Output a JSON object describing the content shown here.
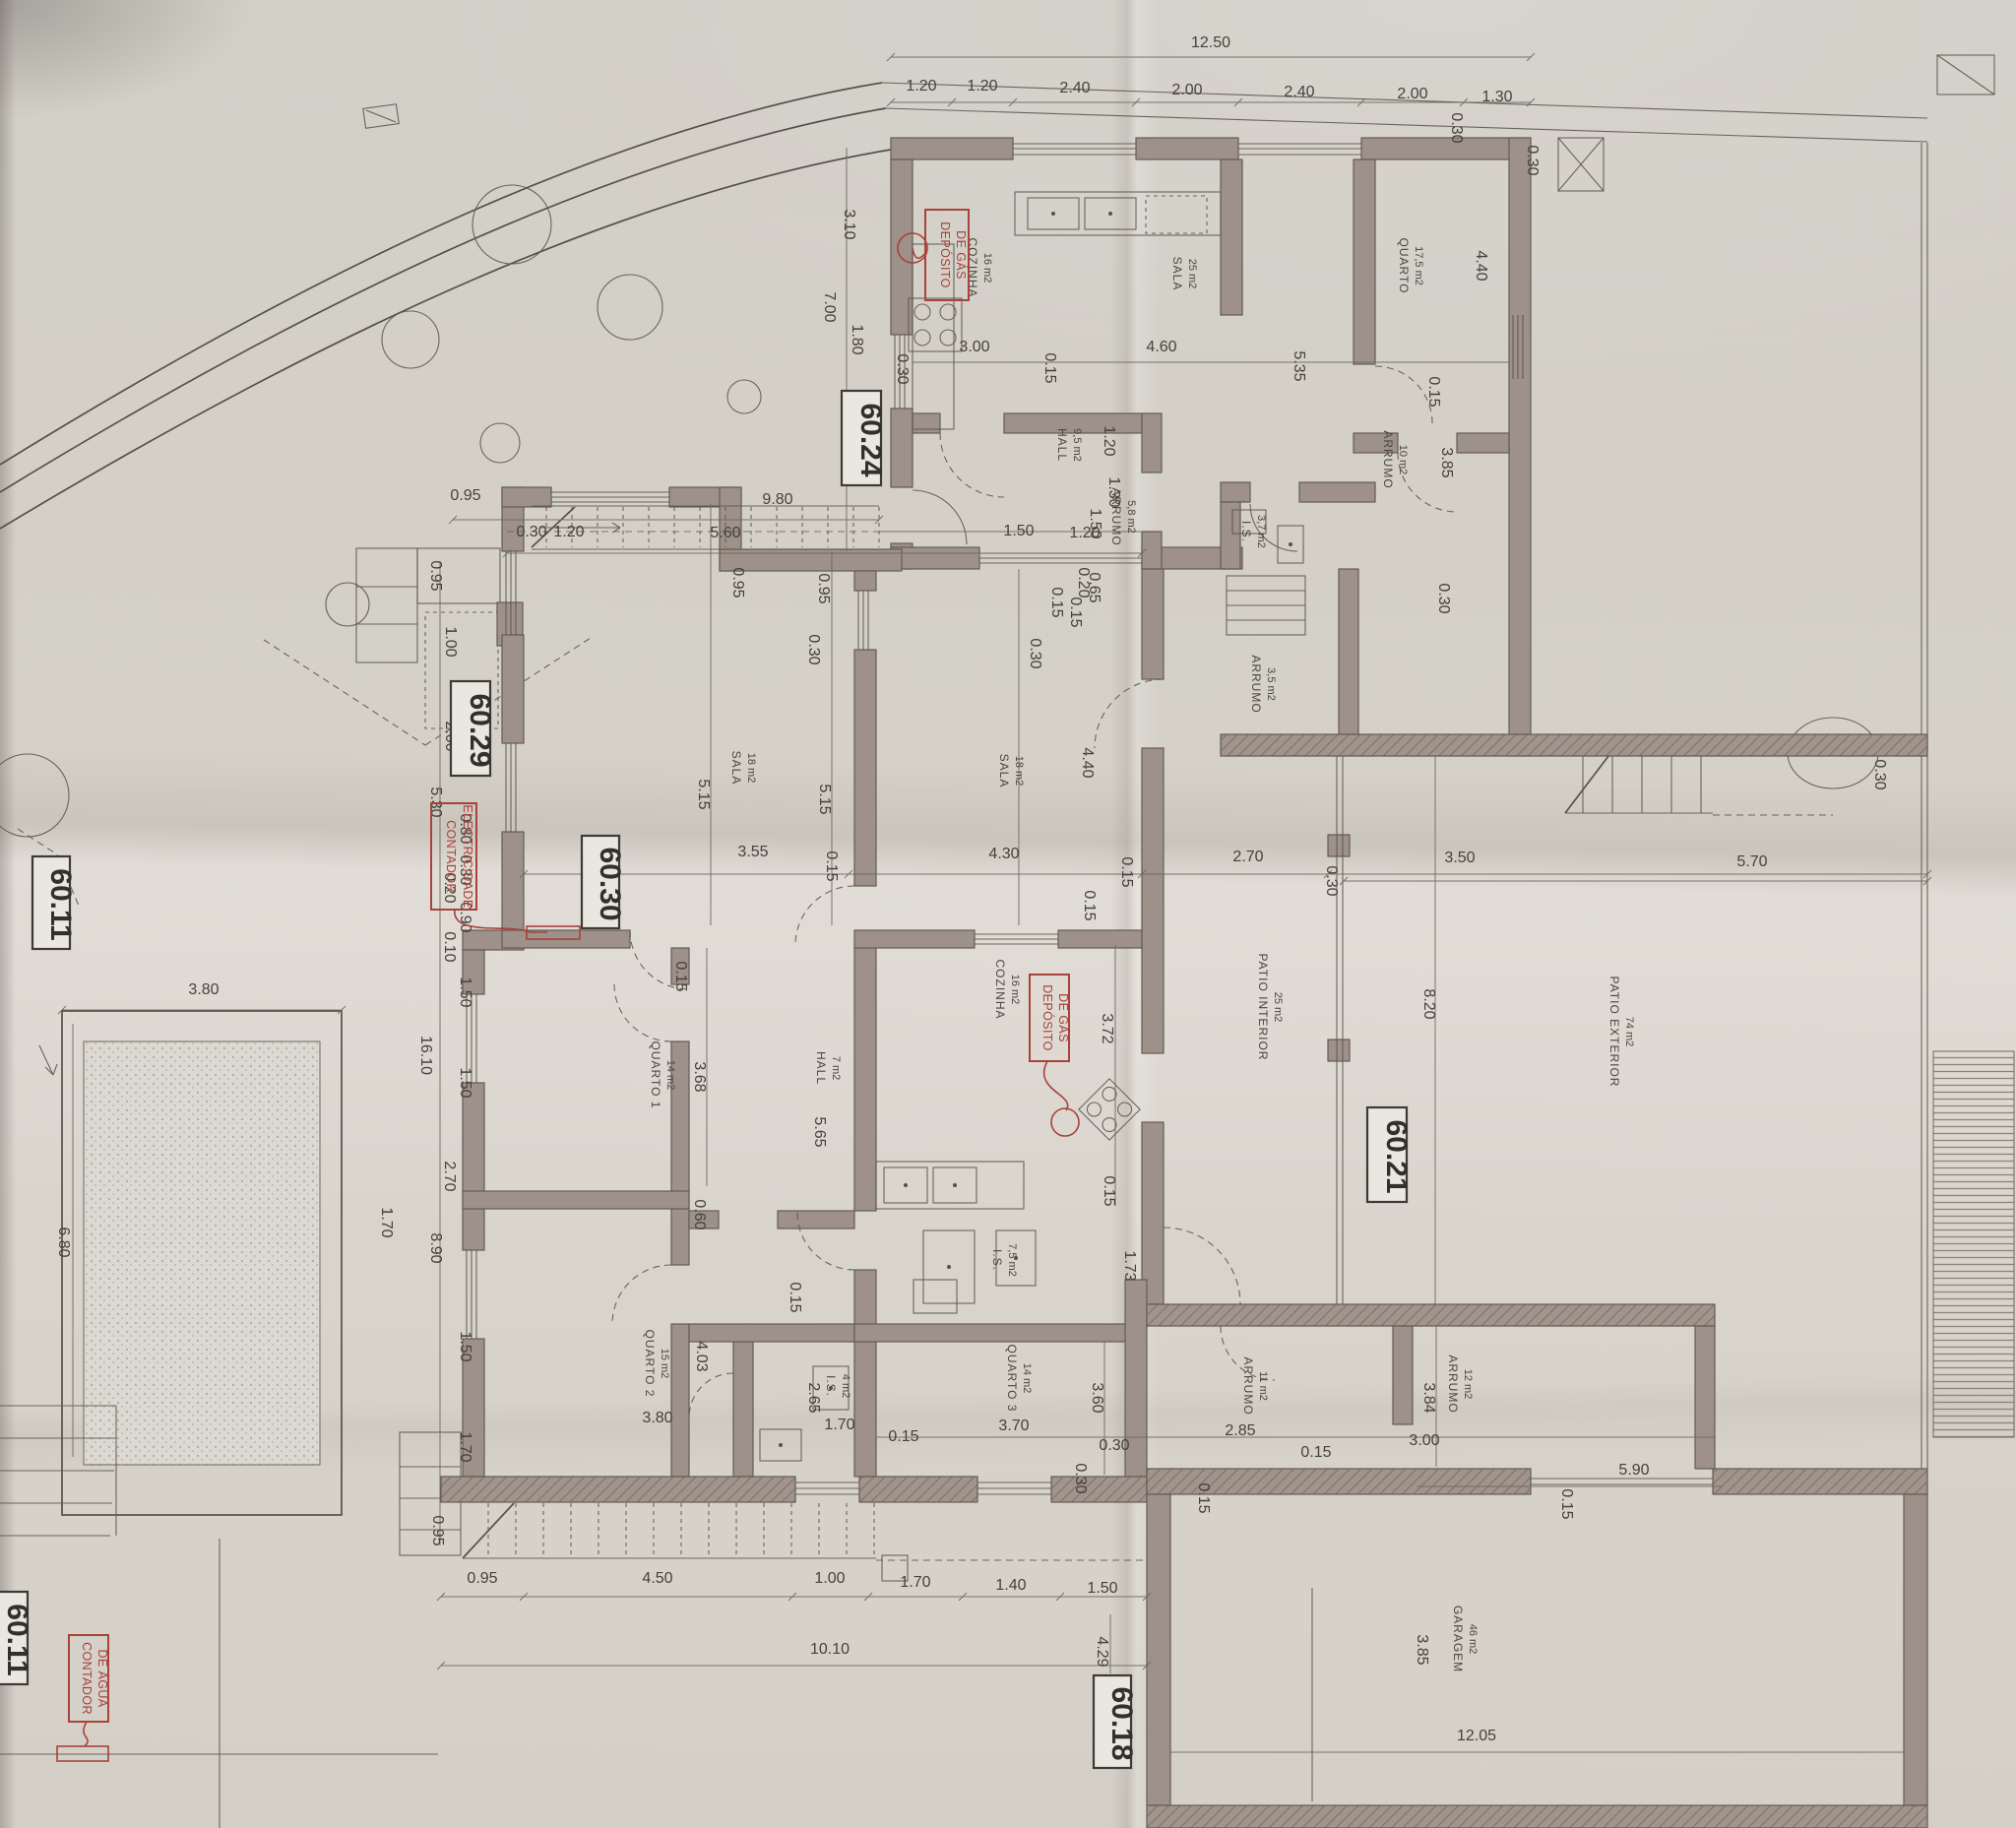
{
  "drawing": {
    "kind": "architectural site / floor plan (photographed blueprint)",
    "language": "Portuguese"
  },
  "markers": [
    "60.24",
    "60.29",
    "60.30",
    "60.11",
    "60.21",
    "60.18",
    "60.11"
  ],
  "red_labels": {
    "gas": [
      "DEPÓSITO",
      "DE GÁS"
    ],
    "electricity": [
      "CONTADOR",
      "ELECTRICIDADE"
    ],
    "water": [
      "CONTADOR",
      "DE ÁGUA"
    ]
  },
  "rooms": [
    {
      "name": "COZINHA",
      "area": "16 m2"
    },
    {
      "name": "SALA",
      "area": "25 m2"
    },
    {
      "name": "QUARTO",
      "area": "17,5 m2"
    },
    {
      "name": "HALL",
      "area": "9,5 m2"
    },
    {
      "name": "ARRUMO",
      "area": "5,8 m2"
    },
    {
      "name": "ARRUMO",
      "area": "3,5 m2"
    },
    {
      "name": "I.S.",
      "area": "3,7 m2"
    },
    {
      "name": "ARRUMO",
      "area": "10 m2"
    },
    {
      "name": "SALA",
      "area": "18 m2"
    },
    {
      "name": "SALA",
      "area": "18 m2"
    },
    {
      "name": "QUARTO 1",
      "area": "14 m2"
    },
    {
      "name": "HALL",
      "area": "7 m2"
    },
    {
      "name": "COZINHA",
      "area": "16 m2"
    },
    {
      "name": "I.S.",
      "area": "7,5 m2"
    },
    {
      "name": "QUARTO 2",
      "area": "15 m2"
    },
    {
      "name": "I.S.",
      "area": "4 m2"
    },
    {
      "name": "QUARTO 3",
      "area": "14 m2"
    },
    {
      "name": "ARRUMO",
      "area": "11 m2"
    },
    {
      "name": "ARRUMO",
      "area": "12 m2"
    },
    {
      "name": "PATIO INTERIOR",
      "area": "25 m2"
    },
    {
      "name": "PATIO EXTERIOR",
      "area": "74 m2"
    },
    {
      "name": "GARAGEM",
      "area": "46 m2"
    }
  ],
  "dims": [
    "12.50",
    "1.20",
    "1.20",
    "2.40",
    "2.00",
    "2.40",
    "2.00",
    "1.30",
    "0.30",
    "3.10",
    "7.00",
    "1.80",
    "0.30",
    "3.00",
    "0.15",
    "4.60",
    "5.35",
    "4.40",
    "0.15",
    "3.85",
    "0.30",
    "1.20",
    "1.50",
    "0.20",
    "0.95",
    "9.80",
    "0.30",
    "1.20",
    "5.60",
    "1.50",
    "1.20",
    "1.30",
    "0.65",
    "0.15",
    "0.95",
    "0.95",
    "0.30",
    "0.15",
    "0.30",
    "4.40",
    "5.15",
    "5.15",
    "3.55",
    "0.15",
    "4.30",
    "0.15",
    "2.70",
    "0.30",
    "3.50",
    "5.70",
    "8.20",
    "0.30",
    "0.95",
    "1.00",
    "2.00",
    "5.30",
    "0.80",
    "0.30",
    "0.20",
    "0.90",
    "0.10",
    "1.50",
    "16.10",
    "1.50",
    "2.70",
    "8.90",
    "1.70",
    "1.50",
    "1.70",
    "0.95",
    "3.80",
    "6.80",
    "0.15",
    "3.68",
    "0.60",
    "5.65",
    "0.15",
    "3.72",
    "0.15",
    "1.73",
    "0.15",
    "4.03",
    "2.65",
    "3.80",
    "1.70",
    "0.15",
    "3.60",
    "3.70",
    "0.30",
    "0.30",
    "2.85",
    "0.15",
    "3.84",
    "3.00",
    "0.15",
    "0.95",
    "4.50",
    "1.00",
    "1.70",
    "1.40",
    "1.50",
    "10.10",
    "4.29",
    "3.85",
    "5.90",
    "12.05",
    "0.15",
    "0.30"
  ]
}
